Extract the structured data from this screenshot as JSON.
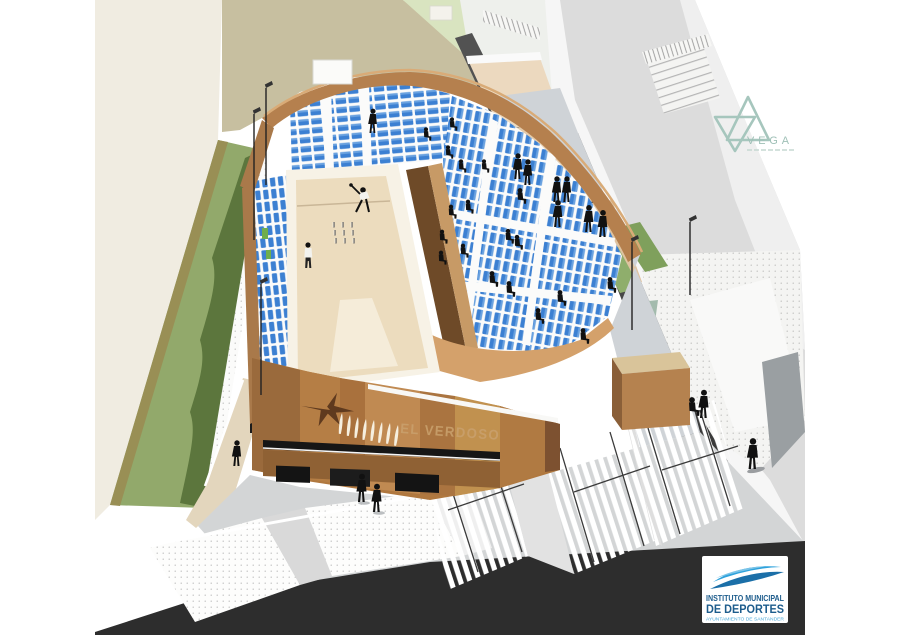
{
  "render": {
    "alt_text": "Aerial architectural rendering of an open-air bolera stadium with blue tiered seating around a sand playing court, timber facade, public staircases, grass embankment and access road"
  },
  "facade_sign": {
    "text": "EL VERDOSO",
    "color": "#c9a06c"
  },
  "vega_logo": {
    "text": "VEGA",
    "color": "#9fc0b7",
    "icon": "overlapping-triangles-icon"
  },
  "imd_logo": {
    "line1": "INSTITUTO MUNICIPAL",
    "line2": "DE DEPORTES",
    "line3": "AYUNTAMIENTO DE SANTANDER",
    "text_color": "#1d5c8c",
    "line3_color": "#4aa8d8",
    "swoosh_dark": "#1b6fa8",
    "swoosh_bright": "#2ea2dc",
    "background": "#ffffff"
  },
  "palette": {
    "seat_blue": "#3c80d2",
    "timber_brown": "#b5804e",
    "facade_brown": "#b0783f",
    "court_sand": "#ecdcbe",
    "grass_light": "#92a96b",
    "grass_dark": "#5c763d",
    "grass_pale": "#d9e4c0",
    "background_khaki": "#c7bfa0",
    "background_cream": "#f0ece1",
    "plaza_gray": "#d3d5d6",
    "street_dark": "#2d2d2d",
    "wall_charcoal": "#4a4a4a"
  }
}
